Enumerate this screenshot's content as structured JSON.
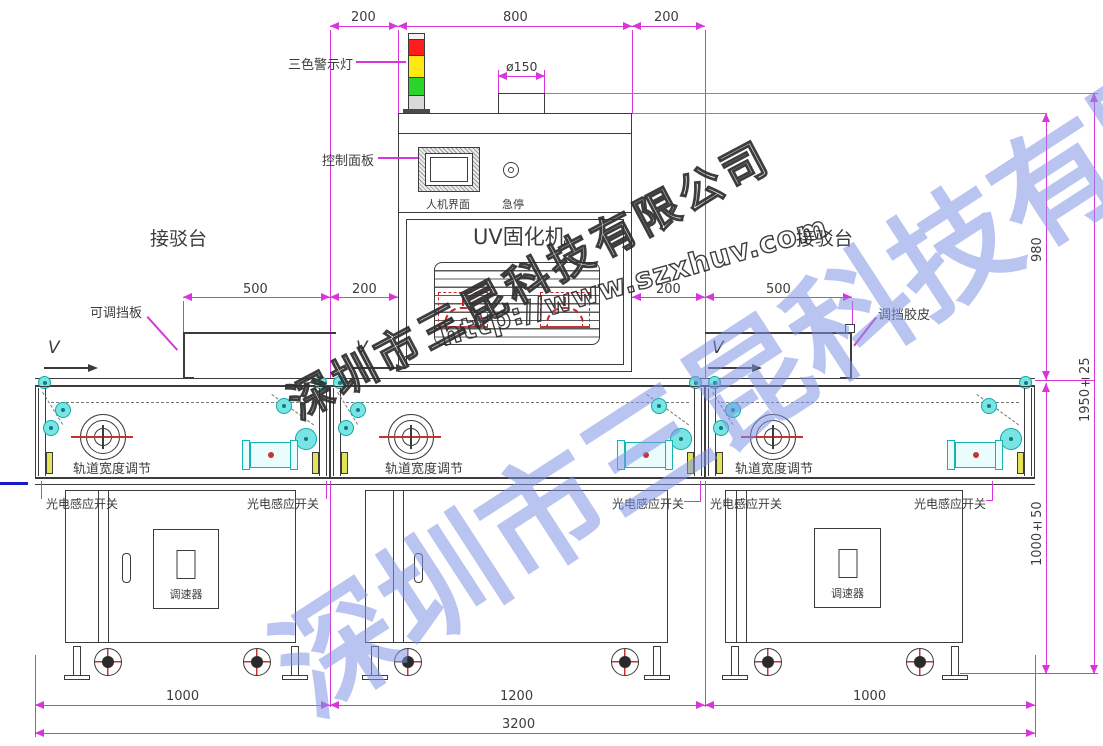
{
  "watermark": {
    "company": "深圳市三昆科技有限公司",
    "url": "http://www.szxhuv.com",
    "blue": "#8094e6"
  },
  "labels": {
    "warning_light": "三色警示灯",
    "control_panel": "控制面板",
    "hmi": "人机界面",
    "emergency_stop": "急停",
    "machine_name": "UV固化机",
    "left_station": "接驳台",
    "right_station": "接驳台",
    "adjustable_baffle": "可调挡板",
    "baffle_rubber": "调挡胶皮",
    "direction_v": "V",
    "track_width": "轨道宽度调节",
    "photo_sensor": "光电感应开关",
    "speed_controller": "调速器"
  },
  "dimensions": {
    "top_left": "200",
    "top_center": "800",
    "top_right": "200",
    "duct_diameter": "ø150",
    "left_baffle_len": "500",
    "left_gap": "200",
    "right_gap": "200",
    "right_baffle_len": "500",
    "machine_height": "980",
    "table_height": "1000±50",
    "total_height": "1950±25",
    "bottom_left": "1000",
    "bottom_center": "1200",
    "bottom_right": "1000",
    "bottom_total": "3200"
  },
  "colors": {
    "dimension": "#d936d9",
    "line": "#3c3c3c",
    "roller": "#7ae4e4",
    "sensor": "#e3e35a",
    "lamp": "#c62828",
    "light_red": "#ff1c1c",
    "light_yellow": "#ffe813",
    "light_green": "#2ad42a"
  }
}
